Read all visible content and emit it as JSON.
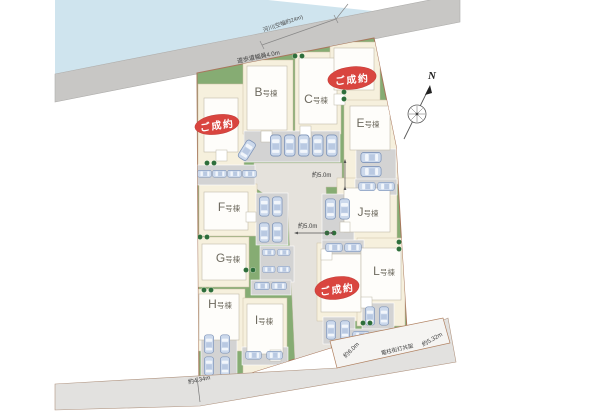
{
  "map": {
    "river_label": "河川(空幅約24m)",
    "promenade_label": "遊歩道幅員4.0m",
    "north_label": "N",
    "sold_stamp": "ご成約",
    "buildings": {
      "b": "B号棟",
      "c": "C号棟",
      "e": "E号棟",
      "f": "F号棟",
      "g": "G号棟",
      "h": "H号棟",
      "i": "I号棟",
      "j": "J号棟",
      "l": "L号棟"
    },
    "dimensions": {
      "east_road": "約5.0m",
      "south_road": "約5.0m",
      "southwest_road": "約4.34m",
      "south_strip_west": "約6.0m",
      "utility_pole": "電柱街灯共架",
      "south_strip_east": "約5.32m"
    },
    "colors": {
      "site_green": "#86ac73",
      "lot_cream": "#f6f0dd",
      "top_road": "#c8c7c5",
      "inner_road": "#e5e2dc",
      "river": "#cfe4ee",
      "sold_red": "#d9453f",
      "car_body": "#ccd9ec",
      "boundary_brown": "#a8765c"
    }
  }
}
